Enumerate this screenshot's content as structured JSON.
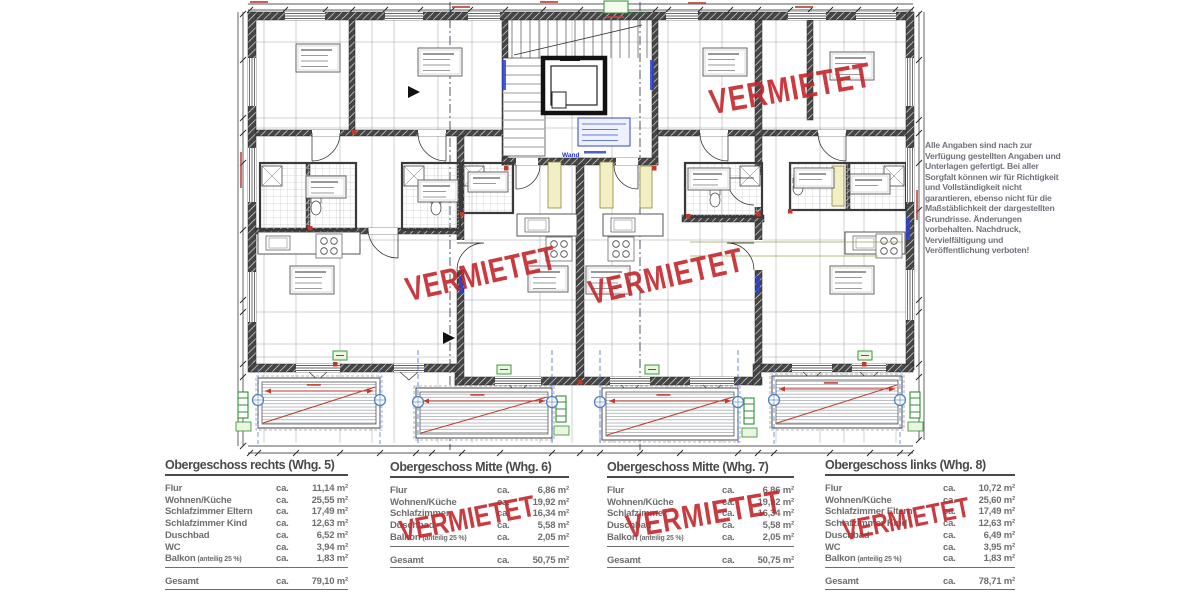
{
  "stamp": {
    "text": "VERMIETET",
    "color": "#c5262c"
  },
  "plan": {
    "wand_label": "Wand"
  },
  "disclaimer": {
    "text": "Alle Angaben sind nach zur\nVerfügung gestellten Angaben und\nUnterlagen gefertigt. Bei aller\nSorgfalt können wir für Richtigkeit\nund Vollständigkeit nicht\ngarantieren, ebenso nicht für die\nMaßstäblichkeit der dargestellten\nGrundrisse. Änderungen\nvorbehalten. Nachdruck,\nVervielfältigung und\nVeröffentlichung verboten!"
  },
  "tables": [
    {
      "title": "Obergeschoss rechts (Whg. 5)",
      "rented": false,
      "rows": [
        {
          "label": "Flur",
          "ca": "ca.",
          "value": "11,14 m²"
        },
        {
          "label": "Wohnen/Küche",
          "ca": "ca.",
          "value": "25,55 m²"
        },
        {
          "label": "Schlafzimmer Eltern",
          "ca": "ca.",
          "value": "17,49 m²"
        },
        {
          "label": "Schlafzimmer Kind",
          "ca": "ca.",
          "value": "12,63 m²"
        },
        {
          "label": "Duschbad",
          "ca": "ca.",
          "value": "6,52 m²"
        },
        {
          "label": "WC",
          "ca": "ca.",
          "value": "3,94 m²"
        },
        {
          "label": "Balkon",
          "sublabel": "(anteilig 25 %)",
          "ca": "ca.",
          "value": "1,83 m²",
          "underline": true
        }
      ],
      "total": {
        "label": "Gesamt",
        "ca": "ca.",
        "value": "79,10 m²"
      }
    },
    {
      "title": "Obergeschoss Mitte (Whg. 6)",
      "rented": true,
      "rows": [
        {
          "label": "Flur",
          "ca": "ca.",
          "value": "6,86 m²"
        },
        {
          "label": "Wohnen/Küche",
          "ca": "ca.",
          "value": "19,92 m²"
        },
        {
          "label": "Schlafzimmer",
          "ca": "ca.",
          "value": "16,34 m²"
        },
        {
          "label": "Duschbad",
          "ca": "ca.",
          "value": "5,58 m²"
        },
        {
          "label": "Balkon",
          "sublabel": "(anteilig 25 %)",
          "ca": "ca.",
          "value": "2,05 m²",
          "underline": true
        }
      ],
      "total": {
        "label": "Gesamt",
        "ca": "ca.",
        "value": "50,75 m²"
      }
    },
    {
      "title": "Obergeschoss Mitte (Whg. 7)",
      "rented": true,
      "rows": [
        {
          "label": "Flur",
          "ca": "ca.",
          "value": "6,86 m²"
        },
        {
          "label": "Wohnen/Küche",
          "ca": "ca.",
          "value": "19,92 m²"
        },
        {
          "label": "Schlafzimmer",
          "ca": "ca.",
          "value": "16,34 m²"
        },
        {
          "label": "Duschbad",
          "ca": "ca.",
          "value": "5,58 m²"
        },
        {
          "label": "Balkon",
          "sublabel": "(anteilig 25 %)",
          "ca": "ca.",
          "value": "2,05 m²",
          "underline": true
        }
      ],
      "total": {
        "label": "Gesamt",
        "ca": "ca.",
        "value": "50,75 m²"
      }
    },
    {
      "title": "Obergeschoss links (Whg. 8)",
      "rented": true,
      "rows": [
        {
          "label": "Flur",
          "ca": "ca.",
          "value": "10,72 m²"
        },
        {
          "label": "Wohnen/Küche",
          "ca": "ca.",
          "value": "25,60 m²"
        },
        {
          "label": "Schlafzimmer Eltern",
          "ca": "ca.",
          "value": "17,49 m²"
        },
        {
          "label": "Schlafzimmer Kind",
          "ca": "ca.",
          "value": "12,63 m²"
        },
        {
          "label": "Duschbad",
          "ca": "ca.",
          "value": "6,49 m²"
        },
        {
          "label": "WC",
          "ca": "ca.",
          "value": "3,95 m²"
        },
        {
          "label": "Balkon",
          "sublabel": "(anteilig 25 %)",
          "ca": "ca.",
          "value": "1,83 m²",
          "underline": true
        }
      ],
      "total": {
        "label": "Gesamt",
        "ca": "ca.",
        "value": "78,71 m²"
      }
    }
  ]
}
